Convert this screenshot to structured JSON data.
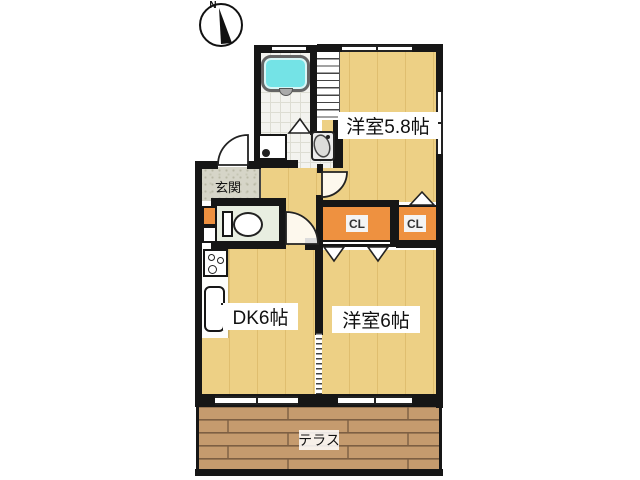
{
  "compass": {
    "label": "N"
  },
  "labels": {
    "room_5_8": "洋室5.8帖",
    "room_6": "洋室6帖",
    "dk": "DK6帖",
    "entrance": "玄関",
    "terrace": "テラス",
    "closet_left": "CL",
    "closet_right": "CL"
  },
  "colors": {
    "wall": "#161616",
    "floor": "#EDD085",
    "floor-line": "#DFBE6F",
    "closet": "#EE9140",
    "terrace-plank": "#C59B6E",
    "terrace-line": "#7D5F43",
    "tub": "#74E3E6",
    "wc-floor": "#E8EEE1",
    "genkan": "#D6D5C8",
    "tile": "#F3F3EF",
    "tile-line": "#DDDDD3"
  }
}
